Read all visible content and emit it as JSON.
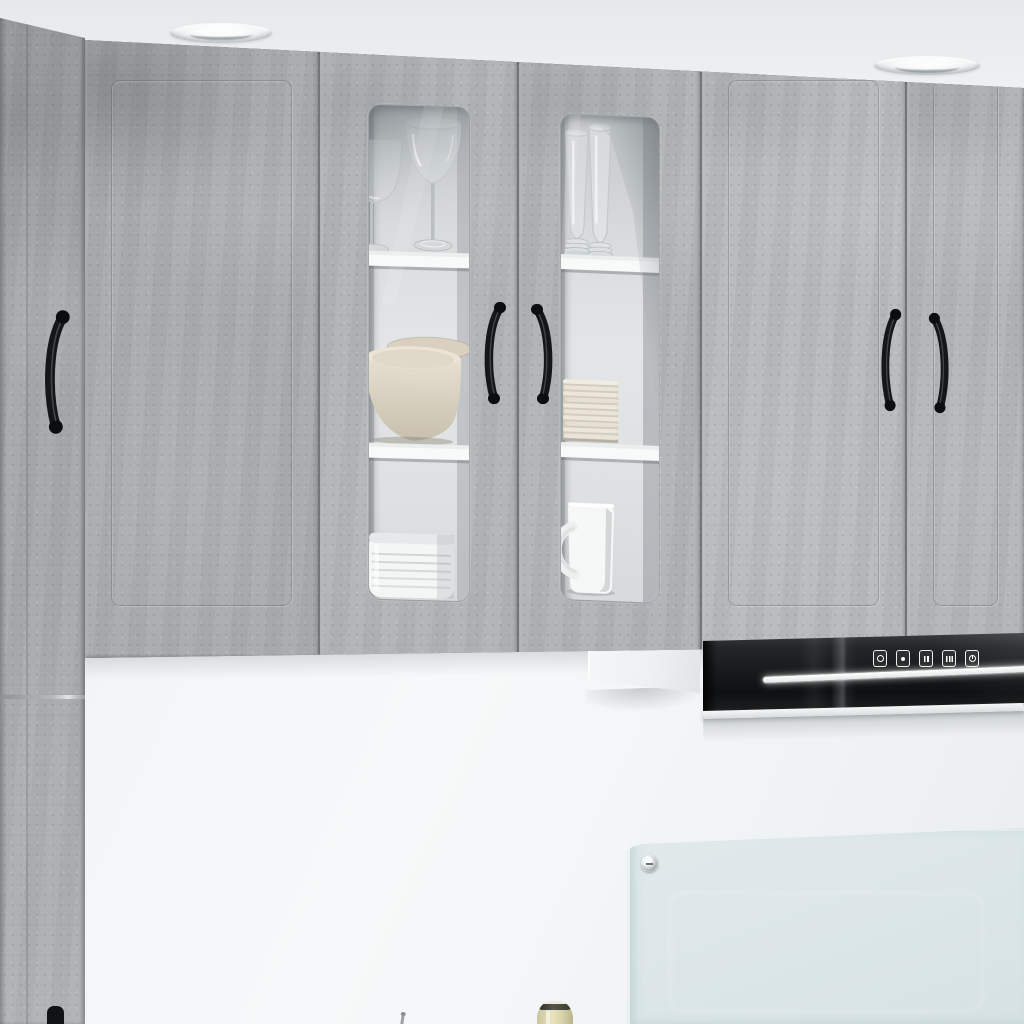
{
  "meta": {
    "description": "Product photo of a concrete-grey kitchen wall cabinet set: plain doors and two glass display doors with tableware, black bow handles, a black range hood with touch buttons and an LED light strip, white wall with a glass splashback, and recessed ceiling spotlights.",
    "style": "concrete grey",
    "no_text_visible": true
  },
  "palette": {
    "concrete_grey": "#afb2b3",
    "concrete_dark": "#8e9192",
    "concrete_light": "#c4c7c8",
    "ceiling_white": "#e9ebed",
    "wall_white": "#f3f5f7",
    "cabinet_interior": "#dfe2e3",
    "shelf_white": "#f7f8f8",
    "handle_black": "#141618",
    "hood_black": "#1b1c1d",
    "led_white": "#ffffff",
    "bowl_beige": "#ddd5c5",
    "plate_cream": "#ece7db",
    "ceramic_white": "#f5f6f6",
    "splashback_glass": "#dfe9ea",
    "bottle_glass": "#ddd8ae"
  },
  "ceiling": {
    "spotlights": [
      {
        "label": "recessed ceiling spotlight left"
      },
      {
        "label": "recessed ceiling spotlight right"
      }
    ]
  },
  "cabinets": {
    "tall_left_unit": {
      "label": "tall concrete-grey cabinet at left edge",
      "upper_handle": "black bow handle",
      "lower_handle": "black bow handle, partially visible at bottom edge"
    },
    "wall_row": {
      "doors": [
        {
          "label": "plain wall-cabinet door, concrete grey"
        },
        {
          "label": "glass display door left"
        },
        {
          "label": "glass display door right"
        },
        {
          "label": "plain wall-cabinet door with handle"
        },
        {
          "label": "plain wall-cabinet door with handle, cropped at right edge"
        }
      ]
    },
    "glass_display_left": {
      "label": "left glass display column",
      "shelves": 3,
      "items": [
        {
          "label": "wine glass, partially visible"
        },
        {
          "label": "wine glass"
        },
        {
          "label": "stacked beige bowls",
          "count": 2
        },
        {
          "label": "white ribbed bowl"
        }
      ]
    },
    "glass_display_right": {
      "label": "right glass display column",
      "shelves": 3,
      "items": [
        {
          "label": "tall beer glasses",
          "count": 2
        },
        {
          "label": "stack of cream side plates",
          "count": 10
        },
        {
          "label": "white mug"
        }
      ]
    },
    "handles_total": 6,
    "handle_style": "black bow handle"
  },
  "range_hood": {
    "label": "black glass range hood",
    "buttons": [
      {
        "icon": "power-icon",
        "label": "power"
      },
      {
        "icon": "light-icon",
        "label": "light"
      },
      {
        "icon": "fan-low-icon",
        "label": "fan speed low"
      },
      {
        "icon": "fan-high-icon",
        "label": "fan speed high"
      },
      {
        "icon": "timer-icon",
        "label": "timer"
      }
    ],
    "light_strip": {
      "label": "white LED light strip"
    }
  },
  "under_cabinet_shelf": {
    "label": "white under-cabinet box"
  },
  "splashback": {
    "label": "glass splashback panel",
    "fixing": "metal standoff screw"
  },
  "accessories": [
    {
      "label": "glass bottle, partially visible at bottom edge"
    },
    {
      "label": "utensil tip, partially visible at bottom edge"
    }
  ]
}
